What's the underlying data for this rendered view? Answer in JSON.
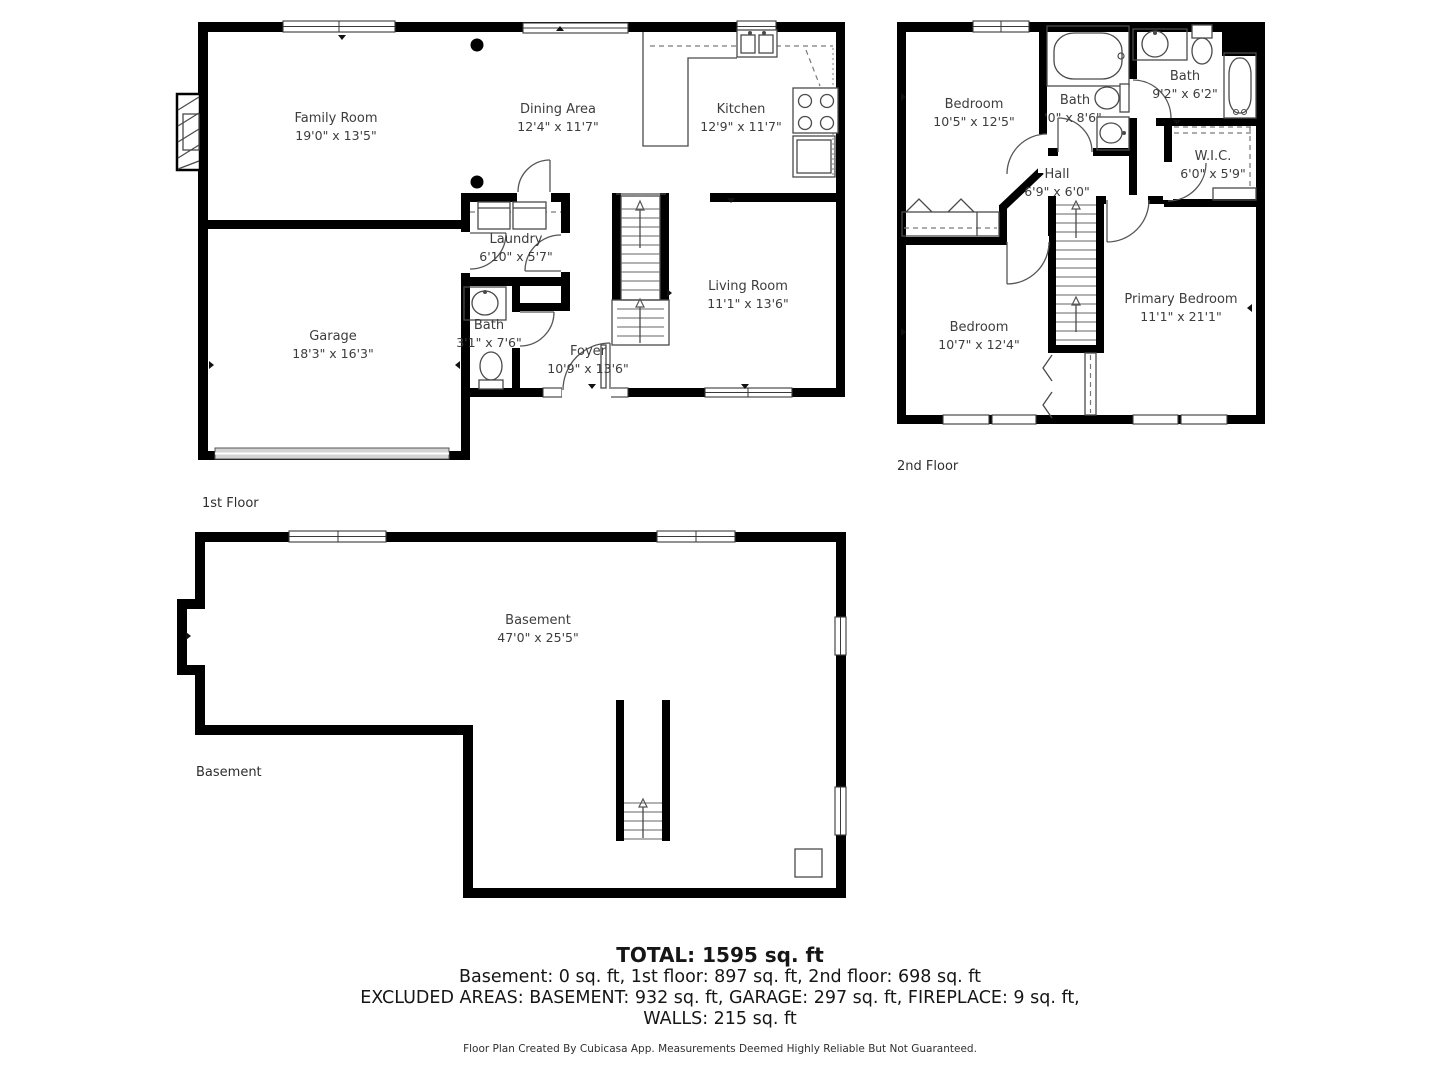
{
  "floors": {
    "first": {
      "label": "1st Floor",
      "rooms": {
        "family_room": {
          "name": "Family Room",
          "dims": "19'0\" x 13'5\""
        },
        "dining_area": {
          "name": "Dining Area",
          "dims": "12'4\" x 11'7\""
        },
        "kitchen": {
          "name": "Kitchen",
          "dims": "12'9\" x 11'7\""
        },
        "laundry": {
          "name": "Laundry",
          "dims": "6'10\" x 5'7\""
        },
        "bath": {
          "name": "Bath",
          "dims": "3'1\" x 7'6\""
        },
        "foyer": {
          "name": "Foyer",
          "dims": "10'9\" x 13'6\""
        },
        "living_room": {
          "name": "Living Room",
          "dims": "11'1\" x 13'6\""
        },
        "garage": {
          "name": "Garage",
          "dims": "18'3\" x 16'3\""
        }
      }
    },
    "second": {
      "label": "2nd Floor",
      "rooms": {
        "bedroom_top": {
          "name": "Bedroom",
          "dims": "10'5\" x 12'5\""
        },
        "bath_middle": {
          "name": "Bath",
          "dims": "'0\" x 8'6\""
        },
        "bath_right": {
          "name": "Bath",
          "dims": "9'2\" x 6'2\""
        },
        "wic": {
          "name": "W.I.C.",
          "dims": "6'0\" x 5'9\""
        },
        "hall": {
          "name": "Hall",
          "dims": "6'9\" x 6'0\""
        },
        "bedroom_bottom": {
          "name": "Bedroom",
          "dims": "10'7\" x 12'4\""
        },
        "primary_bedroom": {
          "name": "Primary Bedroom",
          "dims": "11'1\" x 21'1\""
        }
      }
    },
    "basement": {
      "label": "Basement",
      "rooms": {
        "basement": {
          "name": "Basement",
          "dims": "47'0\" x 25'5\""
        }
      }
    }
  },
  "summary": {
    "total": "TOTAL: 1595 sq. ft",
    "floors_line": "Basement: 0 sq. ft, 1st floor: 897 sq. ft, 2nd floor: 698 sq. ft",
    "excluded_line": "EXCLUDED AREAS: BASEMENT: 932 sq. ft, GARAGE: 297 sq. ft, FIREPLACE: 9 sq. ft,",
    "walls_line": "WALLS: 215 sq. ft"
  },
  "footer": "Floor Plan Created By Cubicasa App. Measurements Deemed Highly Reliable But Not Guaranteed.",
  "colors": {
    "wall": "#000000",
    "fixture": "#4a4a4a",
    "garage_door": "#d4d4d4",
    "label_text": "#3d3d3d",
    "summary_text": "#161616"
  }
}
